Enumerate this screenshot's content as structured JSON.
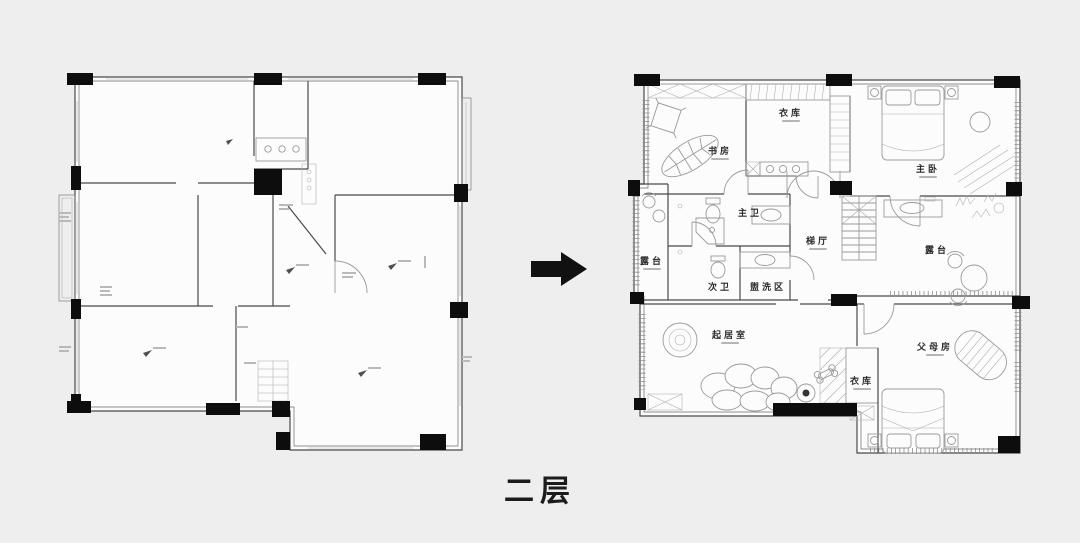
{
  "caption": "二层",
  "arrow": {
    "direction": "right",
    "meaning": "before-to-after"
  },
  "colors": {
    "background": "#eeeeee",
    "plan_paper": "#fcfcfc",
    "wall_line": "#4a4a4a",
    "furniture_line": "#9a9a9a",
    "column_fill": "#0d0d0d",
    "label_text": "#2b2b2b",
    "caption_text": "#1c1c1c"
  },
  "rooms": [
    {
      "id": "study",
      "label": "书房"
    },
    {
      "id": "closet-top",
      "label": "衣库"
    },
    {
      "id": "master-bedroom",
      "label": "主卧"
    },
    {
      "id": "master-bath",
      "label": "主卫"
    },
    {
      "id": "terrace-left",
      "label": "露台"
    },
    {
      "id": "second-bath",
      "label": "次卫"
    },
    {
      "id": "wash-area",
      "label": "盥洗区"
    },
    {
      "id": "stair-hall",
      "label": "梯厅"
    },
    {
      "id": "terrace-right",
      "label": "露台"
    },
    {
      "id": "living-room",
      "label": "起居室"
    },
    {
      "id": "closet-bottom",
      "label": "衣库"
    },
    {
      "id": "parents-room",
      "label": "父母房"
    }
  ]
}
